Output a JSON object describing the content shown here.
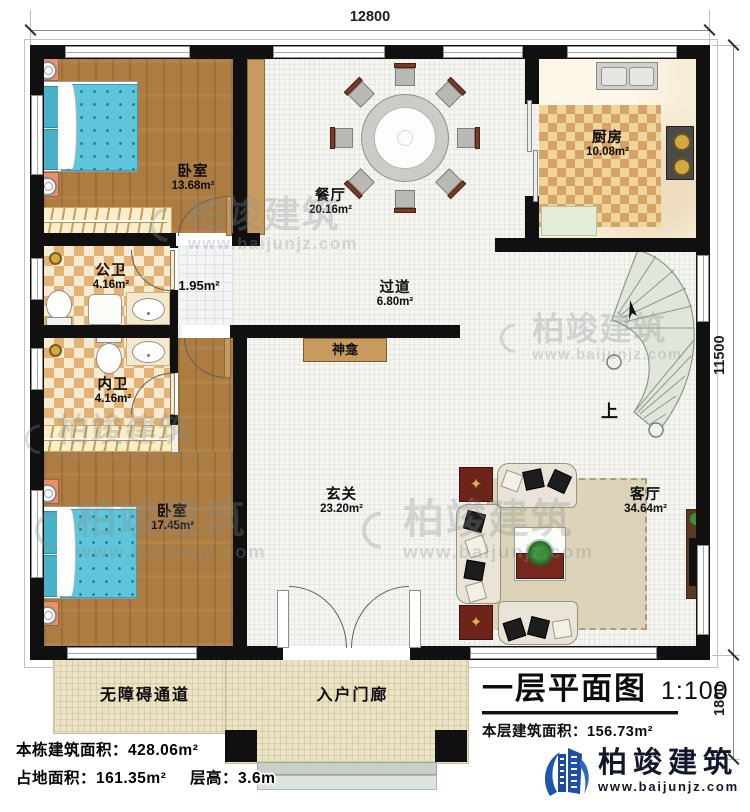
{
  "dimensions": {
    "top": "12800",
    "right_upper": "11500",
    "right_lower": "1800"
  },
  "rooms": [
    {
      "name": "卧室",
      "area": "13.68m²"
    },
    {
      "name": "餐厅",
      "area": "20.16m²"
    },
    {
      "name": "厨房",
      "area": "10.08m²"
    },
    {
      "name": "公卫",
      "area": "4.16m²"
    },
    {
      "name": "",
      "area": "1.95m²"
    },
    {
      "name": "过道",
      "area": "6.80m²"
    },
    {
      "name": "内卫",
      "area": "4.16m²"
    },
    {
      "name": "卧室",
      "area": "17.45m²"
    },
    {
      "name": "玄关",
      "area": "23.20m²"
    },
    {
      "name": "客厅",
      "area": "34.64m²"
    }
  ],
  "features": {
    "shrine": "神龛",
    "stairs_up": "上",
    "ramp": "无障碍通道",
    "porch": "入户门廊"
  },
  "title_block": {
    "title": "一层平面图",
    "scale": "1:100",
    "area_label": "本层建筑面积：",
    "area_value": "156.73m²"
  },
  "stats": {
    "building_area_label": "本栋建筑面积：",
    "building_area_value": "428.06m²",
    "footprint_label": "占地面积：",
    "footprint_value": "161.35m²",
    "height_label": "层高：",
    "height_value": "3.6m"
  },
  "brand": {
    "name": "柏竣建筑",
    "url": "www.baijunjz.com"
  },
  "watermark": {
    "name": "柏竣建筑",
    "url": "www.baijunjz.com"
  }
}
